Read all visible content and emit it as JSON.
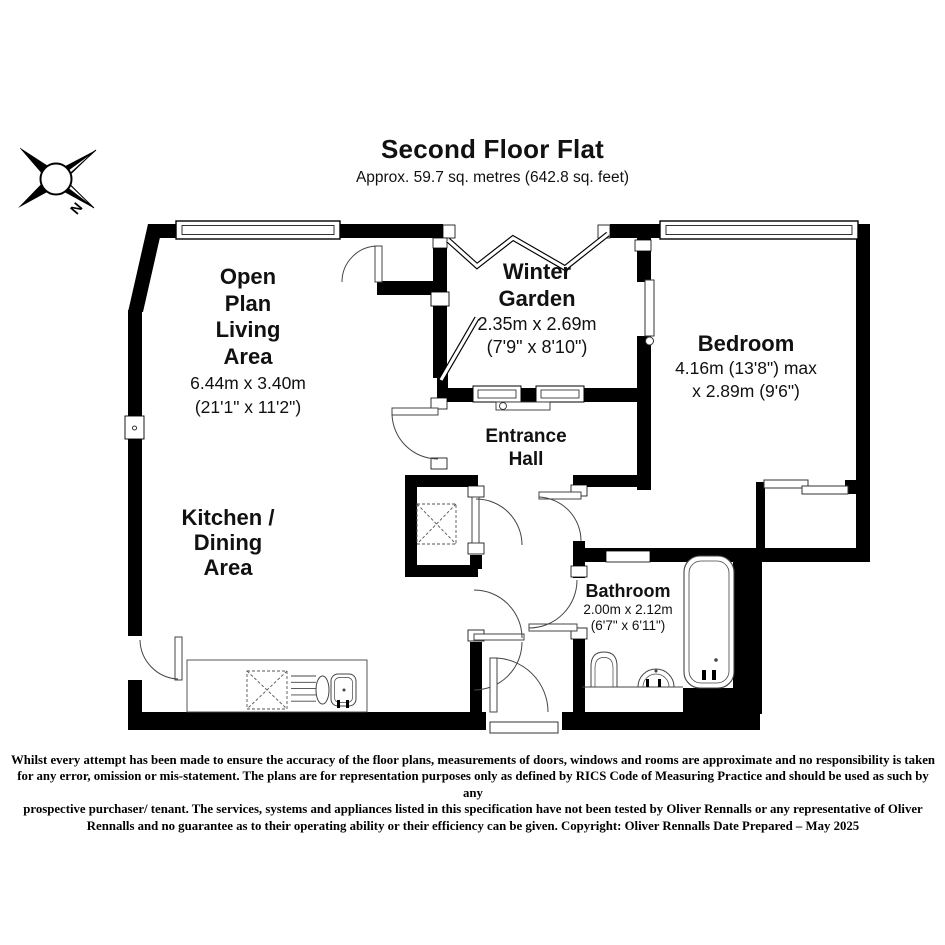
{
  "header": {
    "title": "Second Floor Flat",
    "subtitle": "Approx. 59.7 sq. metres (642.8 sq. feet)"
  },
  "compass": {
    "label": "N"
  },
  "rooms": {
    "living": {
      "name_lines": [
        "Open",
        "Plan",
        "Living",
        "Area"
      ],
      "dims_metric": "6.44m x 3.40m",
      "dims_imperial": "(21'1\" x 11'2\")"
    },
    "winter_garden": {
      "name_lines": [
        "Winter",
        "Garden"
      ],
      "dims_metric": "2.35m x 2.69m",
      "dims_imperial": "(7'9\" x 8'10\")"
    },
    "bedroom": {
      "name": "Bedroom",
      "dims_line1": "4.16m (13'8\") max",
      "dims_line2": "x 2.89m (9'6\")"
    },
    "entrance_hall": {
      "name_lines": [
        "Entrance",
        "Hall"
      ]
    },
    "kitchen": {
      "name_lines": [
        "Kitchen /",
        "Dining",
        "Area"
      ]
    },
    "bathroom": {
      "name": "Bathroom",
      "dims_metric": "2.00m x 2.12m",
      "dims_imperial": "(6'7\" x 6'11\")"
    }
  },
  "disclaimer": {
    "lines": [
      "Whilst every attempt has been made to ensure the accuracy of the floor plans, measurements of doors, windows and rooms are approximate and no responsibility is taken",
      "for any error, omission or mis-statement. The plans are for representation purposes only as defined by RICS Code of Measuring Practice and should be used as such by any",
      "prospective purchaser/ tenant. The services, systems and appliances listed in this specification have not been tested by Oliver Rennalls or any representative of Oliver",
      "Rennalls and no guarantee as to their operating ability or their efficiency can be given. Copyright: Oliver Rennalls Date Prepared – May 2025"
    ]
  },
  "colors": {
    "wall": "#000000",
    "background": "#ffffff",
    "line": "#444444"
  }
}
